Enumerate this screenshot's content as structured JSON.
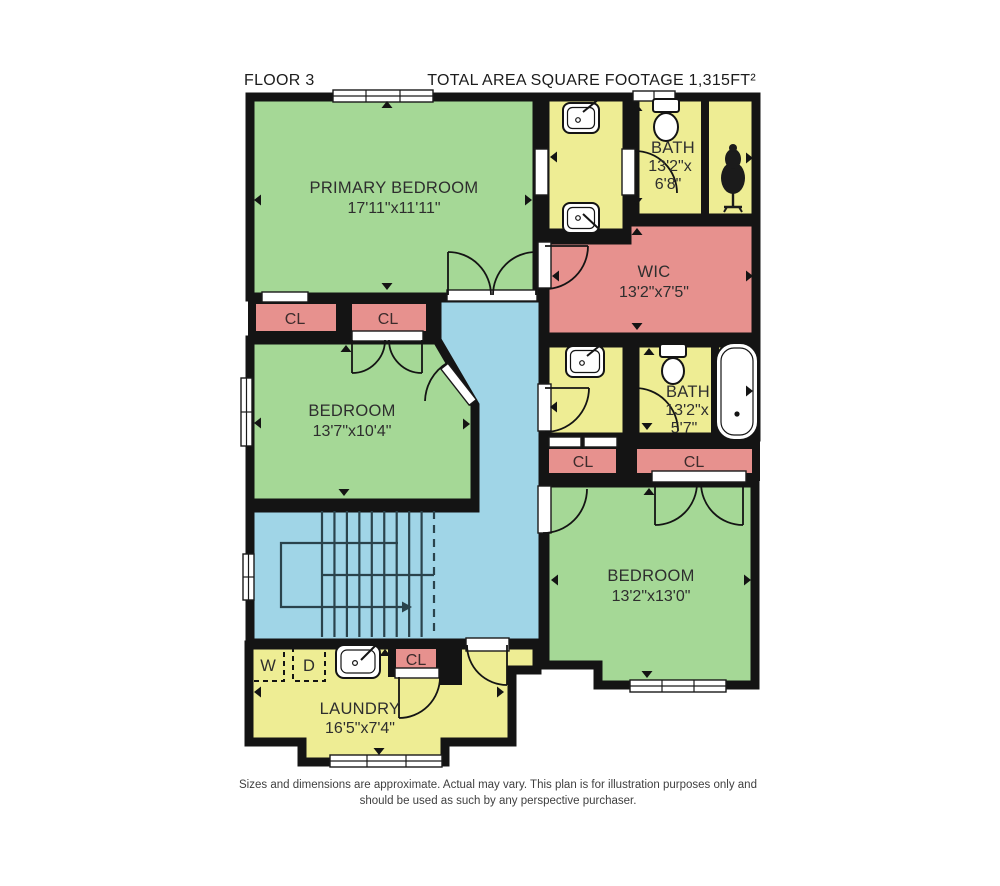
{
  "header": {
    "floor_label": "FLOOR 3",
    "total_area_label": "TOTAL AREA SQUARE FOOTAGE 1,315FT²"
  },
  "rooms": {
    "primary_bedroom": {
      "name": "PRIMARY BEDROOM",
      "dims": "17'11\"x11'11\""
    },
    "bath_top": {
      "name": "BATH",
      "dims1": "13'2\"x",
      "dims2": "6'8\""
    },
    "wic": {
      "name": "WIC",
      "dims": "13'2\"x7'5\""
    },
    "bedroom_mid": {
      "name": "BEDROOM",
      "dims": "13'7\"x10'4\""
    },
    "bath_mid": {
      "name": "BATH",
      "dims1": "13'2\"x",
      "dims2": "5'7\""
    },
    "bedroom_right": {
      "name": "BEDROOM",
      "dims": "13'2\"x13'0\""
    },
    "laundry": {
      "name": "LAUNDRY",
      "dims": "16'5\"x7'4\""
    }
  },
  "labels": {
    "closet": "CL",
    "washer": "W",
    "dryer": "D"
  },
  "footer": {
    "line1": "Sizes and dimensions are approximate. Actual may vary. This plan is for illustration purposes only and",
    "line2": "should be used as such by any perspective purchaser."
  },
  "colors": {
    "bedroom_fill": "#a5d896",
    "bath_fill": "#eeed94",
    "closet_fill": "#e7918e",
    "hall_fill": "#a0d5e7",
    "wall": "#141414"
  }
}
